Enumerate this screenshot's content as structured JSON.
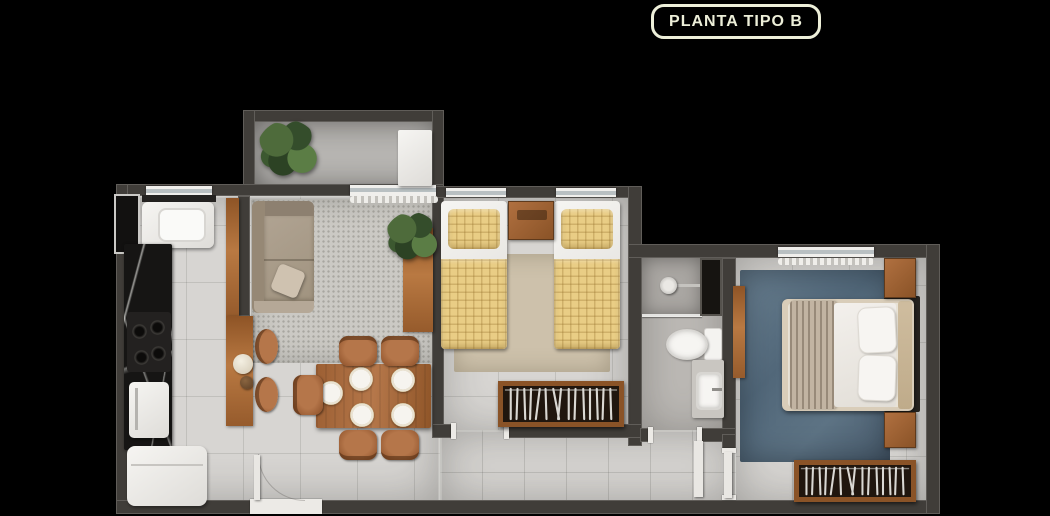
{
  "badge": {
    "label": "PLANTA TIPO B",
    "text_color": "#edefd9",
    "border_color": "#edefd9",
    "background": "#000000"
  },
  "canvas": {
    "width": 1050,
    "height": 516,
    "background": "#000000"
  },
  "floorplan": {
    "view": "top-down-apartment-render",
    "palette": {
      "wall": "#403d39",
      "floor_tile": "#d7d5d2",
      "balcony_floor": "#b7b5b2",
      "countertop_marble": "#161514",
      "wood": "#a86a3c",
      "sofa": "#a99c8a",
      "bed_quilt_yellow": "#e9cd85",
      "bedroom_rug": "#cdc1ab",
      "master_rug_blue": "#5d7384",
      "fixtures_white": "#f2f1ee",
      "wardrobe_interior": "#20160e",
      "plant_green": "#49653a"
    },
    "rooms": [
      {
        "name": "balcony",
        "furniture": [
          "potted-plant",
          "ac-unit"
        ]
      },
      {
        "name": "kitchen",
        "furniture": [
          "laundry-sink",
          "marble-countertop",
          "cooktop",
          "sink-cabinet",
          "refrigerator"
        ]
      },
      {
        "name": "living-dining-room",
        "furniture": [
          "sofa",
          "breakfast-bar",
          "bar-stool",
          "bar-stool",
          "decor-vases",
          "console-with-plant",
          "dining-table",
          "dining-chairs",
          "plates",
          "speckled-rug"
        ]
      },
      {
        "name": "bedroom-2",
        "furniture": [
          "single-bed",
          "single-bed",
          "nightstand",
          "beige-rug",
          "open-wardrobe"
        ]
      },
      {
        "name": "bathroom",
        "furniture": [
          "shower",
          "toilet",
          "vanity-sink",
          "service-shaft"
        ]
      },
      {
        "name": "master-bedroom",
        "furniture": [
          "double-bed",
          "nightstand",
          "nightstand",
          "blue-rug",
          "open-wardrobe",
          "side-desk"
        ]
      },
      {
        "name": "hallway",
        "furniture": []
      }
    ],
    "counts": {
      "dining_chairs": 5,
      "bar_stools": 2,
      "plates": 5,
      "single_beds": 2,
      "double_beds": 1,
      "wardrobes": 2
    }
  }
}
